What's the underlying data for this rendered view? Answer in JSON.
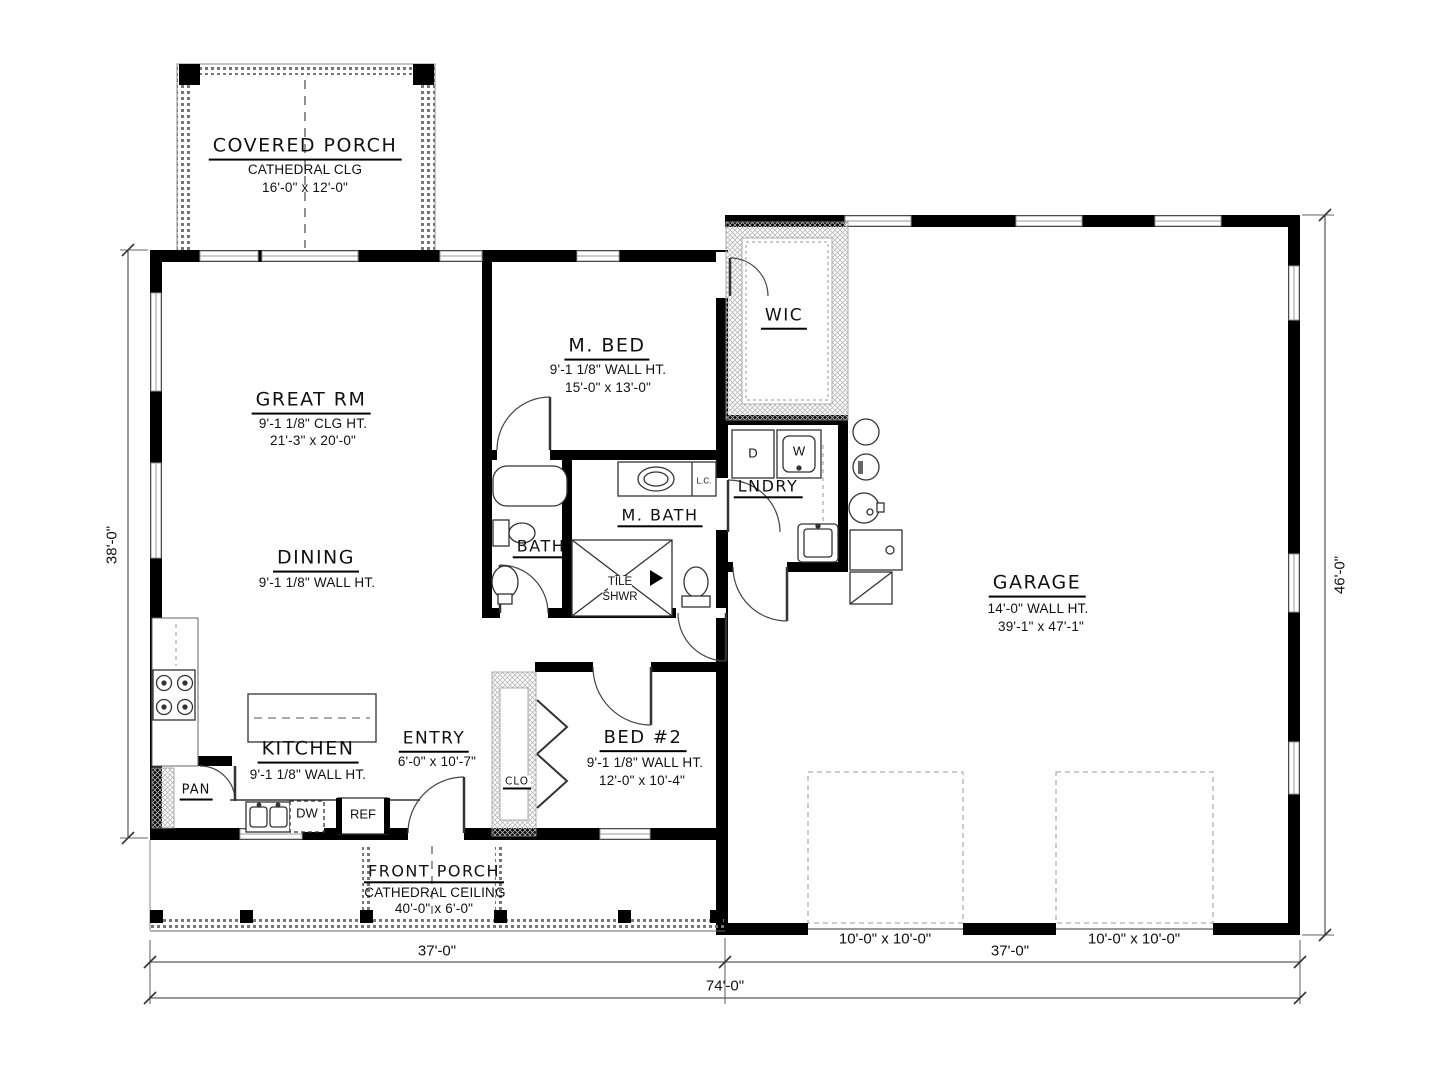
{
  "rooms": {
    "covered_porch": {
      "name": "COVERED PORCH",
      "ceiling": "CATHEDRAL CLG",
      "size": "16'-0\" x 12'-0\""
    },
    "great_rm": {
      "name": "GREAT RM",
      "ceiling": "9'-1 1/8\" CLG HT.",
      "size": "21'-3\" x 20'-0\""
    },
    "dining": {
      "name": "DINING",
      "ceiling": "9'-1 1/8\" WALL HT."
    },
    "m_bed": {
      "name": "M. BED",
      "ceiling": "9'-1 1/8\" WALL HT.",
      "size": "15'-0\" x 13'-0\""
    },
    "wic": {
      "name": "WIC"
    },
    "lndry": {
      "name": "LNDRY"
    },
    "bath": {
      "name": "BATH"
    },
    "m_bath": {
      "name": "M. BATH"
    },
    "tile_shwr": {
      "line1": "TILE",
      "line2": "SHWR"
    },
    "kitchen": {
      "name": "KITCHEN",
      "ceiling": "9'-1 1/8\" WALL HT."
    },
    "pan": {
      "name": "PAN"
    },
    "entry": {
      "name": "ENTRY",
      "size": "6'-0\" x 10'-7\""
    },
    "clo": {
      "name": "CLO"
    },
    "bed2": {
      "name": "BED #2",
      "ceiling": "9'-1 1/8\" WALL HT.",
      "size": "12'-0\" x 10'-4\""
    },
    "garage": {
      "name": "GARAGE",
      "ceiling": "14'-0\" WALL HT.",
      "size": "39'-1\" x 47'-1\""
    },
    "front_porch": {
      "name": "FRONT PORCH",
      "ceiling": "CATHEDRAL CEILING",
      "size": "40'-0\" x 6'-0\""
    }
  },
  "appliances": {
    "dryer": "D",
    "washer": "W",
    "dishwasher": "DW",
    "refrigerator": "REF",
    "linen_cabinet": "L.C."
  },
  "dimensions": {
    "house_depth": "38'-0\"",
    "garage_depth": "46'-0\"",
    "house_width": "37'-0\"",
    "garage_width": "37'-0\"",
    "total_width": "74'-0\"",
    "garage_door_1": "10'-0\" x 10'-0\"",
    "garage_door_2": "10'-0\" x 10'-0\""
  },
  "colors": {
    "wall": "#000000",
    "window": "#999999",
    "hatch": "#b8b8b8",
    "background": "#ffffff"
  }
}
